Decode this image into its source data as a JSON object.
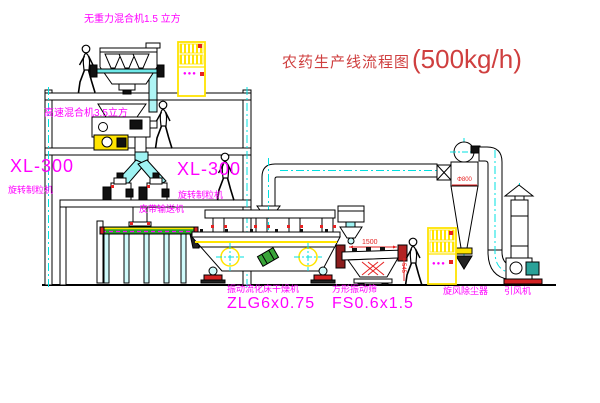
{
  "title": {
    "text": "农药生产线流程图",
    "capacity": "(500kg/h)"
  },
  "equipment_labels": {
    "gravity_free_mixer": "无重力混合机1.5 立方",
    "high_speed_mixer": "高速混合机3.5立方",
    "granulator_left": {
      "model": "XL-300",
      "name": "旋转制粒机"
    },
    "granulator_right": {
      "model": "XL-300",
      "name": "旋转制粒机"
    },
    "belt_conveyor": "皮带输送机",
    "fluid_bed_dryer": {
      "name": "振动流化床干燥机",
      "model": "ZLG6x0.75"
    },
    "vibrating_sieve": {
      "name": "方形振动筛",
      "model": "FS0.6x1.5"
    },
    "cyclone": {
      "name": "旋风除尘器",
      "dimension": "Φ800"
    },
    "induced_draft_fan": {
      "name": "引风机"
    }
  },
  "dimensions": {
    "sieve_length": "1500",
    "sieve_height": "545"
  },
  "control_cabinet": {
    "indicator_dots": "●●●"
  },
  "colors": {
    "line": "#000000",
    "centerline_cyan": "#00e0e0",
    "label_magenta": "#ff00ff",
    "title_red": "#cf3f3f",
    "dimension_red": "#e62222",
    "highlight_yellow": "#ffe400",
    "conveyor_green": "#28a428",
    "machine_green": "#3aa53a",
    "motor_teal": "#2aa198",
    "base_red": "#d22222",
    "discharge_maroon": "#8b1d1d"
  }
}
